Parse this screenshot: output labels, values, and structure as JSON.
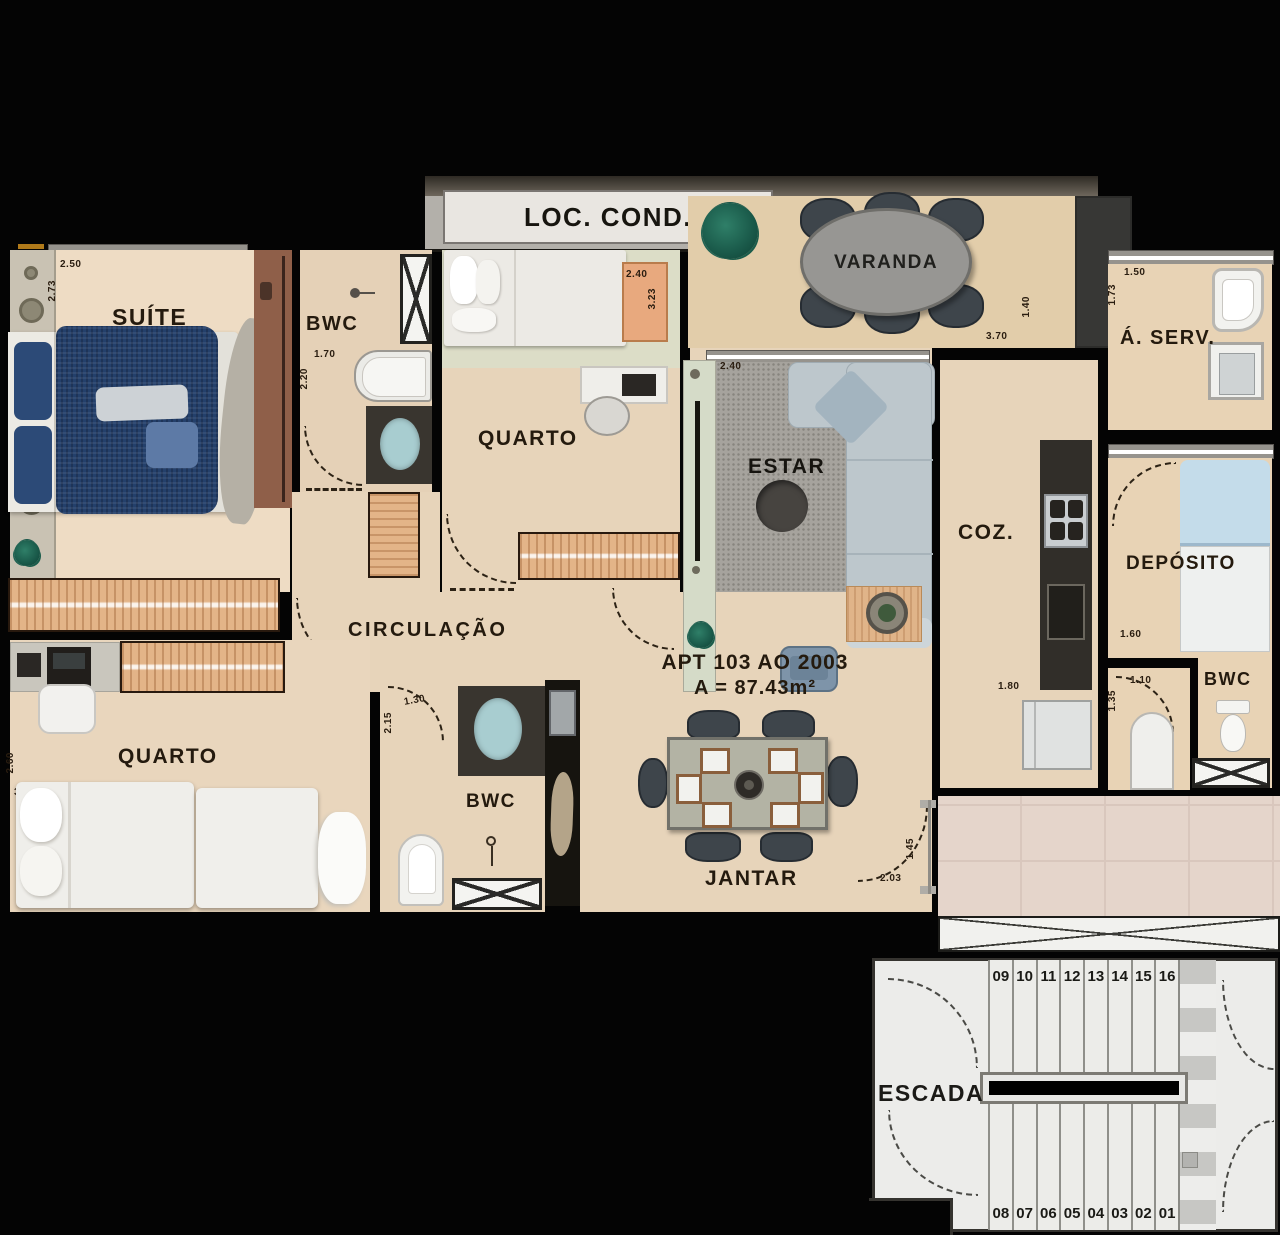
{
  "labels": {
    "loc_cond": "LOC. COND.",
    "varanda": "VARANDA",
    "suite": "SUÍTE",
    "bwc1": "BWC",
    "quarto1": "QUARTO",
    "aserv": "Á. SERV.",
    "estar": "ESTAR",
    "coz": "COZ.",
    "deposito": "DEPÓSITO",
    "bwc2": "BWC",
    "circulacao": "CIRCULAÇÃO",
    "quarto2": "QUARTO",
    "bwc3": "BWC",
    "jantar": "JANTAR",
    "escada": "ESCADA"
  },
  "apartment": {
    "line1": "APT 103 AO 2003",
    "line2": "A = 87.43m²"
  },
  "dims": {
    "suite_w": "2.50",
    "suite_h": "2.73",
    "bwc1_w": "1.70",
    "bwc1_h": "2.20",
    "quarto1_w": "2.40",
    "quarto1_h": "3.23",
    "varanda_w": "3.70",
    "varanda_h": "1.40",
    "aserv_w": "1.50",
    "aserv_h": "1.73",
    "estar_w": "2.40",
    "coz_w": "1.80",
    "deposito_w": "1.60",
    "vest_w": "1.10",
    "vest_h": "1.35",
    "bwc3_w": "1.30",
    "bwc3_h": "2.15",
    "jantar_door_w": "2.03",
    "jantar_door_h": "1.45",
    "quarto2_w": "3.13",
    "quarto2_h": "2.60"
  },
  "escada": {
    "steps_top": [
      "09",
      "10",
      "11",
      "12",
      "13",
      "14",
      "15",
      "16"
    ],
    "steps_bottom": [
      "08",
      "07",
      "06",
      "05",
      "04",
      "03",
      "02",
      "01"
    ]
  },
  "colors": {
    "background": "#040404",
    "floor": "#e7d4ba",
    "varanda_floor": "#e2cdaa",
    "hall_floor": "#e5d5cb",
    "wood": "#e3b488",
    "door_wood": "#8f5f49",
    "navy_bed": "#24406b",
    "teal_sink": "#a8cdd0",
    "sofa": "#bdc7cc",
    "rug": "#a6a39d",
    "counter_dark": "#312e29",
    "stairs": "#ececea"
  }
}
